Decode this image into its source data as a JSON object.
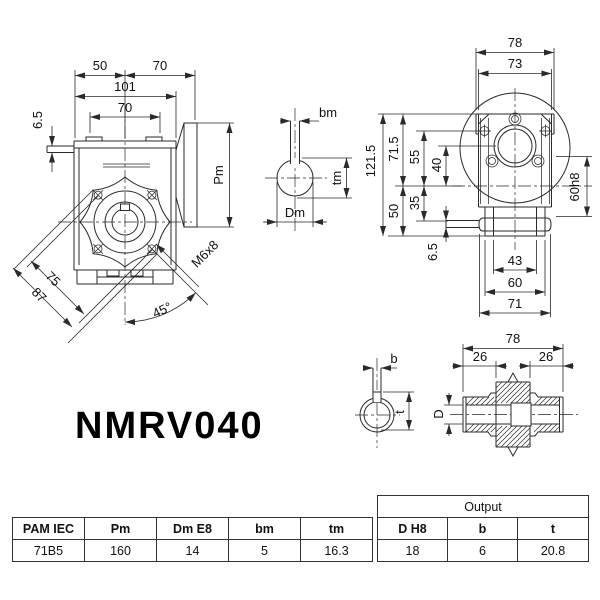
{
  "title": "NMRV040",
  "front": {
    "dim_50": "50",
    "dim_70_top": "70",
    "dim_101": "101",
    "dim_70_bolt": "70",
    "dim_6_5": "6.5",
    "dim_pm": "Pm",
    "thread_callout": "M6x8",
    "dim_75": "75",
    "dim_87": "87",
    "dim_angle": "45°"
  },
  "input_shaft": {
    "dim_bm": "bm",
    "dim_tm": "tm",
    "dim_dm": "Dm"
  },
  "side": {
    "dim_78": "78",
    "dim_73": "73",
    "dim_121_5": "121.5",
    "dim_71_5": "71.5",
    "dim_55": "55",
    "dim_40": "40",
    "dim_50": "50",
    "dim_35": "35",
    "dim_6_5": "6.5",
    "dim_60h8": "60h8",
    "dim_43": "43",
    "dim_60": "60",
    "dim_71": "71"
  },
  "output_shaft": {
    "dim_78": "78",
    "dim_26_left": "26",
    "dim_26_right": "26",
    "dim_b": "b",
    "dim_t": "t",
    "dim_d": "D"
  },
  "tables": {
    "main": {
      "headers": [
        "PAM IEC",
        "Pm",
        "Dm E8",
        "bm",
        "tm"
      ],
      "row": [
        "71B5",
        "160",
        "14",
        "5",
        "16.3"
      ]
    },
    "output": {
      "group_header": "Output",
      "headers": [
        "D H8",
        "b",
        "t"
      ],
      "row": [
        "18",
        "6",
        "20.8"
      ]
    }
  }
}
